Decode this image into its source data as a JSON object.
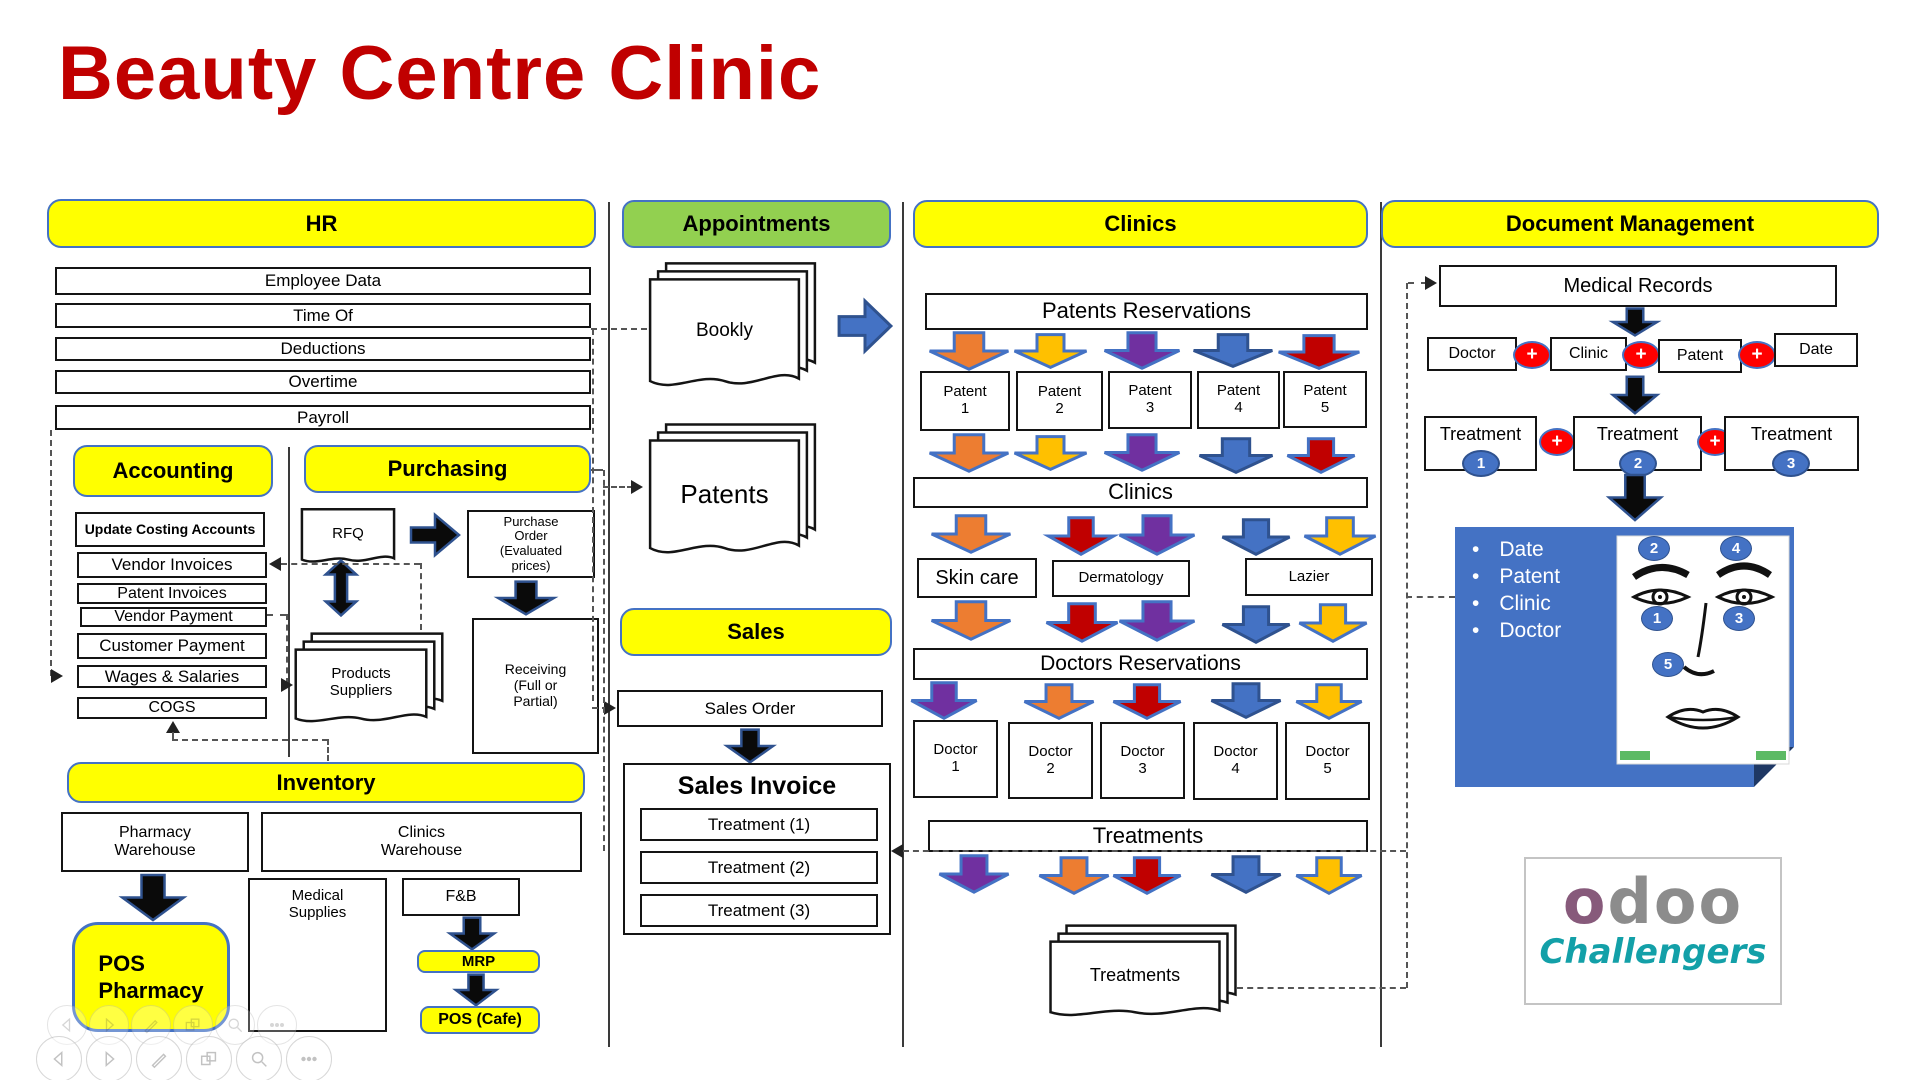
{
  "title": "Beauty Centre Clinic",
  "hr": {
    "header": "HR",
    "rows": [
      "Employee Data",
      "Time Of",
      "Deductions",
      "Overtime",
      "Payroll"
    ],
    "accounting": {
      "header": "Accounting",
      "items": [
        "Update Costing Accounts",
        "Vendor Invoices",
        "Patent Invoices",
        "Vendor Payment",
        "Customer Payment",
        "Wages & Salaries",
        "COGS"
      ]
    },
    "purchasing": {
      "header": "Purchasing",
      "rfq": "RFQ",
      "purchase_order": "Purchase\nOrder\n(Evaluated\nprices)",
      "products_suppliers": "Products\nSuppliers",
      "receiving": "Receiving\n(Full or\nPartial)"
    },
    "inventory": {
      "header": "Inventory",
      "pharmacy_warehouse": "Pharmacy\nWarehouse",
      "clinics_warehouse": "Clinics\nWarehouse",
      "pos_pharmacy": "POS\nPharmacy",
      "medical_supplies": "Medical\nSupplies",
      "fnb": "F&B",
      "mrp": "MRP",
      "pos_cafe": "POS (Cafe)"
    }
  },
  "appointments": {
    "header": "Appointments",
    "bookly": "Bookly",
    "patents": "Patents"
  },
  "sales": {
    "header": "Sales",
    "order": "Sales Order",
    "invoice_title": "Sales Invoice",
    "invoice_items": [
      "Treatment (1)",
      "Treatment (2)",
      "Treatment (3)"
    ]
  },
  "clinics": {
    "header": "Clinics",
    "reservations_bar": "Patents Reservations",
    "patients": [
      "Patent\n1",
      "Patent\n2",
      "Patent\n3",
      "Patent\n4",
      "Patent\n5"
    ],
    "clinics_bar": "Clinics",
    "specialties": [
      "Skin care",
      "Dermatology",
      "Lazier"
    ],
    "doctors_bar": "Doctors Reservations",
    "doctors": [
      "Doctor\n1",
      "Doctor\n2",
      "Doctor\n3",
      "Doctor\n4",
      "Doctor\n5"
    ],
    "treatments_bar": "Treatments",
    "treatments_doc": "Treatments"
  },
  "doc_management": {
    "header": "Document Management",
    "medical_records": "Medical Records",
    "chain": [
      "Doctor",
      "Clinic",
      "Patent",
      "Date"
    ],
    "plus": "+",
    "treatments": [
      {
        "label": "Treatment",
        "num": "1"
      },
      {
        "label": "Treatment",
        "num": "2"
      },
      {
        "label": "Treatment",
        "num": "3"
      }
    ],
    "bullet": "•",
    "panel_bullets": [
      "Date",
      "Patent",
      "Clinic",
      "Doctor"
    ],
    "face_numbers": {
      "n1": "1",
      "n2": "2",
      "n3": "3",
      "n4": "4",
      "n5": "5"
    }
  },
  "logo": {
    "odoo_first": "o",
    "odoo_rest": "doo",
    "challengers": "Challengers"
  },
  "colors": {
    "yellow": "#FFFF00",
    "green": "#92D050",
    "blue_accent": "#4472C4",
    "orange": "#ED7D31",
    "amber": "#FFC000",
    "purple": "#7030A0",
    "red": "#C00000",
    "plus_red": "#FF0000",
    "panel_blue": "#4472C4",
    "teal": "#13A0A8",
    "title_red": "#C00000",
    "odoo_grey": "#8C8C8C",
    "odoo_purple": "#875A7B"
  }
}
